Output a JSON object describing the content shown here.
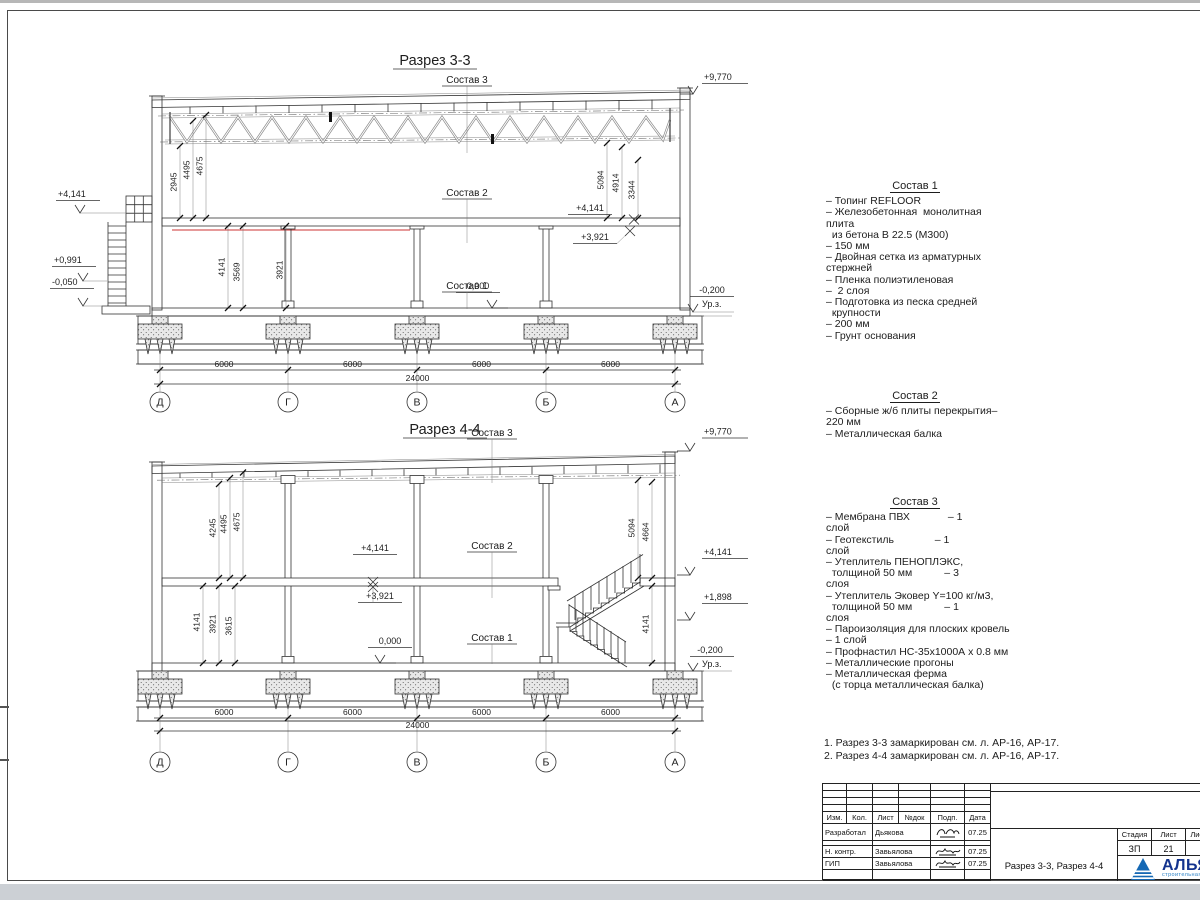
{
  "axes": {
    "grid": [
      "Д",
      "Г",
      "В",
      "Б",
      "А"
    ],
    "spans": [
      "6000",
      "6000",
      "6000",
      "6000"
    ],
    "total": "24000"
  },
  "s33": {
    "title": "Разрез 3-3",
    "labels": {
      "c1": "Состав 1",
      "c2": "Состав 2",
      "c3": "Состав 3"
    },
    "elev": {
      "top": "+9,770",
      "left_mid": "+4,141",
      "left_1": "+0,991",
      "left_2": "-0,050",
      "slab": "+4,141",
      "slab_bot": "+3,921",
      "zero": "0,000",
      "ground": "-0,200",
      "ground_label": "Ур.з."
    },
    "dims_ul": [
      "2945",
      "4495",
      "4675"
    ],
    "dims_ll": [
      "4141",
      "3569",
      "3921"
    ],
    "dims_ur": [
      "5094",
      "4914",
      "3344"
    ]
  },
  "s44": {
    "title": "Разрез 4-4",
    "labels": {
      "c1": "Состав 1",
      "c2": "Состав 2",
      "c3": "Состав 3"
    },
    "elev": {
      "top": "+9,770",
      "slab": "+4,141",
      "slab_bot": "+3,921",
      "zero": "0,000",
      "right_mid": "+4,141",
      "stair": "+1,898",
      "ground": "-0,200",
      "ground_label": "Ур.з."
    },
    "dims_ul": [
      "4245",
      "4495",
      "4675"
    ],
    "dims_ll": [
      "4141",
      "3921",
      "3615"
    ],
    "dims_r": [
      "5094",
      "4664"
    ],
    "dim_r_low": "4141"
  },
  "compositions": [
    {
      "title": "Состав 1",
      "lines": [
        "– Топинг REFLOOR",
        "– Железобетонная  монолитная",
        "плита",
        "  из бетона В 22.5 (М300)",
        "– 150 мм",
        "– Двойная сетка из арматурных",
        "стержней",
        "– Пленка полиэтиленовая",
        "–  2 слоя",
        "– Подготовка из песка средней",
        "  крупности",
        "– 200 мм",
        "– Грунт основания"
      ]
    },
    {
      "title": "Состав 2",
      "lines": [
        "– Сборные ж/б плиты перекрытия–",
        "220 мм",
        "– Металлическая балка"
      ]
    },
    {
      "title": "Состав 3",
      "lines": [
        "– Мембрана ПВХ             – 1",
        "слой",
        "– Геотекстиль              – 1",
        "слой",
        "– Утеплитель ПЕНОПЛЭКС,",
        "  толщиной 50 мм           – 3",
        "слоя",
        "– Утеплитель Эковер Y=100 кг/м3,",
        "  толщиной 50 мм           – 1",
        "слоя",
        "– Пароизоляция для плоских кровель",
        "– 1 слой",
        "– Профнастил НС-35х1000А х 0.8 мм",
        "– Металлические прогоны",
        "– Металлическая ферма",
        "  (с торца металлическая балка)"
      ]
    }
  ],
  "notes": [
    "1. Разрез 3-3 замаркирован см. л. АР-16, АР-17.",
    "2. Разрез 4-4 замаркирован см. л. АР-16, АР-17."
  ],
  "titleblock": {
    "headers": [
      "Изм.",
      "Кол.",
      "Лист",
      "№док",
      "Подп.",
      "Дата"
    ],
    "rows": [
      {
        "role": "Разработал",
        "name": "Дьякова",
        "date": "07.25"
      },
      {
        "role": "Н. контр.",
        "name": "Завьялова",
        "date": "07.25"
      },
      {
        "role": "ГИП",
        "name": "Завьялова",
        "date": "07.25"
      }
    ],
    "doc_title": "Разрез 3-3, Разрез 4-4",
    "stage_header": "Стадия",
    "sheet_header": "Лист",
    "sheets_header": "Листов",
    "stage": "ЗП",
    "sheet": "21",
    "sheets": "2",
    "company": "АЛЬЯНС",
    "company_sub": "строительная компания"
  }
}
